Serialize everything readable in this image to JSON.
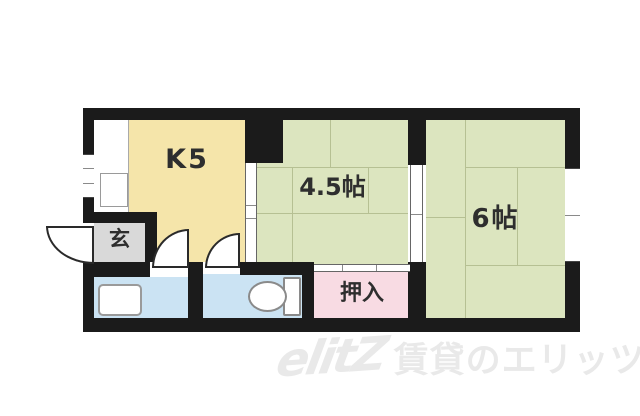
{
  "floor_plan": {
    "kitchen": {
      "label": "K5",
      "color": "#f5e5aa"
    },
    "room_45": {
      "label": "4.5帖",
      "color": "#dce5bf"
    },
    "room_6": {
      "label": "6帖",
      "color": "#dce5bf"
    },
    "entrance": {
      "label": "玄",
      "color": "#d9d9d9"
    },
    "closet": {
      "label": "押入",
      "color": "#f8dbe3"
    },
    "washroom": {
      "color": "#cbe3f3"
    },
    "toilet_room": {
      "color": "#cbe3f3"
    },
    "colors": {
      "wall": "#1b1b1b",
      "tatami_line": "#b6c093",
      "counter": "#ffffff",
      "fixture_border": "#9a9a9a",
      "background": "#ffffff"
    },
    "watermark": {
      "logo": "elitZ",
      "text": "賃貸のエリッツ",
      "color": "#e9e9e9"
    }
  }
}
